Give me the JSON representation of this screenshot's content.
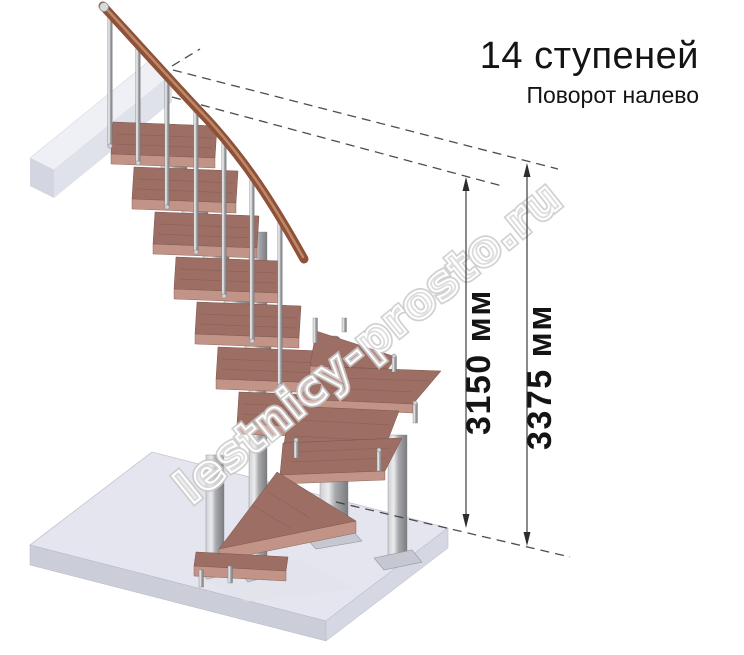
{
  "annotation": {
    "steps_title": "14 ступеней",
    "turn_subtitle": "Поворот налево"
  },
  "dimensions": {
    "inner": {
      "label": "3150 мм"
    },
    "outer": {
      "label": "3375 мм"
    }
  },
  "watermark": {
    "text": "lestnicy-prosto.ru"
  },
  "stair": {
    "colors": {
      "wood_top": "#9d6e64",
      "wood_front": "#c29488",
      "wood_edge": "#7b544c",
      "handrail": "#8f5138",
      "handrail_light": "#c08f6d",
      "floor_top": "#e4e5ee",
      "floor_left": "#cbcdd9",
      "floor_right": "#d5d7e2",
      "landing_top": "#eef0f5",
      "landing_front": "#dfe1eb",
      "landing_cap": "#d3d5e1",
      "dash": "#3a3a3a",
      "dim_text": "#141414",
      "watermark_outline": "#c9c9c9"
    }
  }
}
